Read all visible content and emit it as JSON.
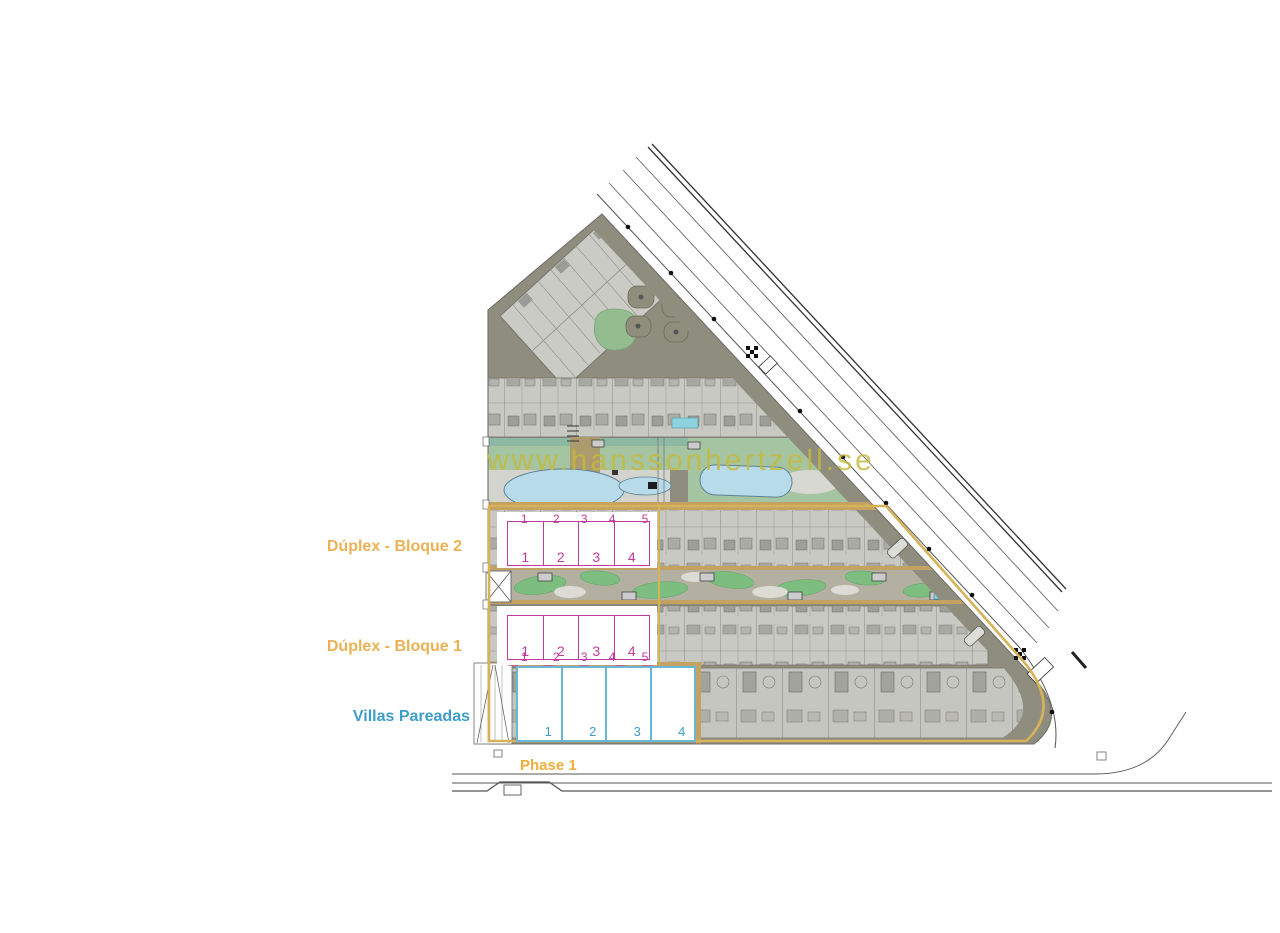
{
  "watermark": "www.hanssonhertzell.se",
  "labels": {
    "bloque2": "Dúplex - Bloque 2",
    "bloque1": "Dúplex - Bloque 1",
    "villas": "Villas Pareadas",
    "phase": "Phase 1"
  },
  "plan": {
    "bloque2": {
      "plot_numbers": [
        "1",
        "2",
        "3",
        "4",
        "5"
      ],
      "unit_numbers": [
        "1",
        "2",
        "3",
        "4"
      ]
    },
    "bloque1": {
      "plot_numbers": [
        "1",
        "2",
        "3",
        "4",
        "5"
      ],
      "unit_numbers": [
        "1",
        "2",
        "3",
        "4"
      ]
    },
    "villas": {
      "unit_numbers": [
        "1",
        "2",
        "3",
        "4"
      ]
    }
  },
  "colors": {
    "accent_gold_label": "#ECB155",
    "phase_label_gold": "#EFAE3B",
    "accent_magenta": "#C23A9C",
    "accent_blue": "#3E9EC9",
    "villas_outline_blue": "#69B7D8",
    "watermark_yellow": "#C6B93C",
    "phase_outline_tan": "#D6B258",
    "pool_blue": "#B7DBE9",
    "garden_green": "#7DBD80",
    "ground_olive": "#8F8D7D",
    "building_gray": "#C9C9C4"
  }
}
